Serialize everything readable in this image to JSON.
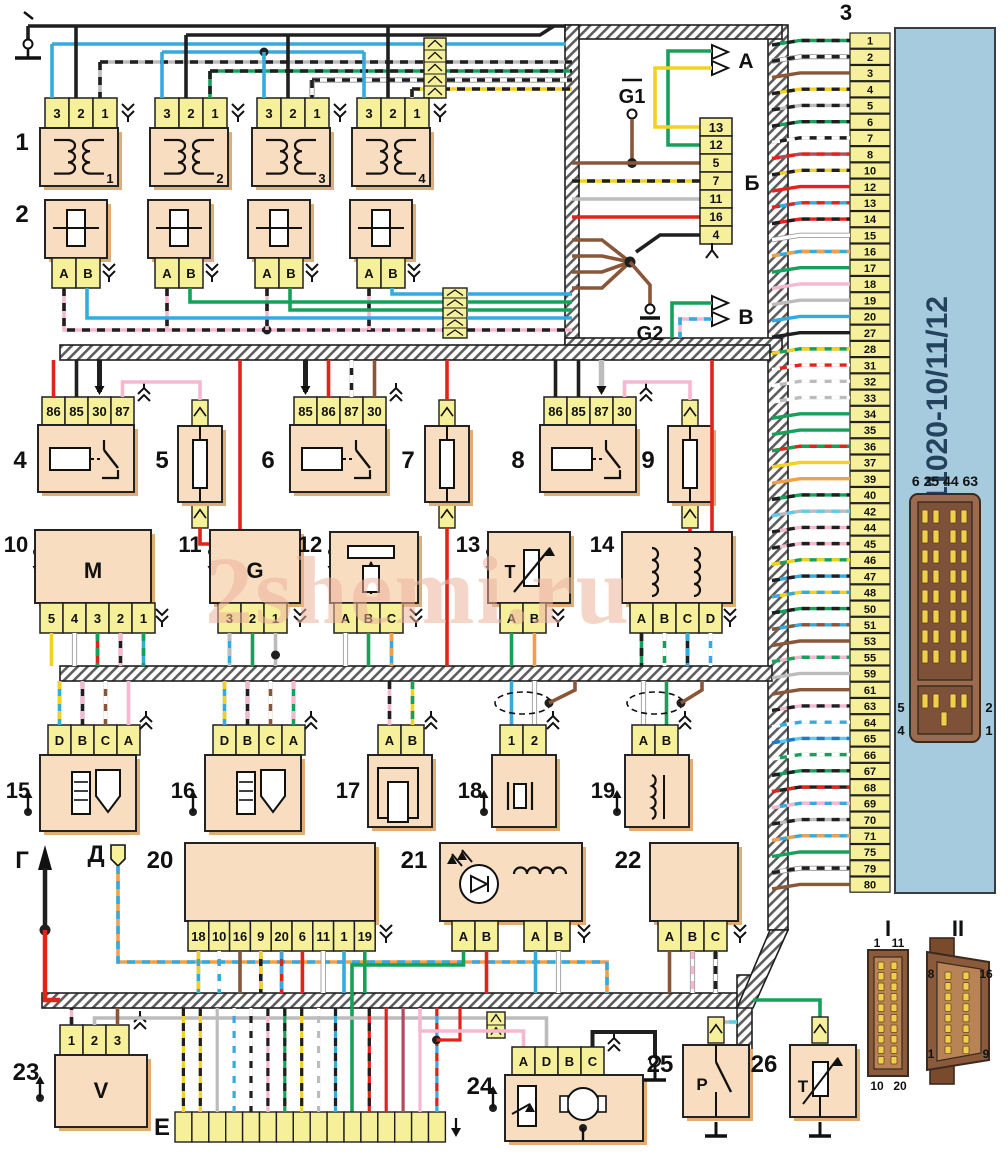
{
  "watermark": "2shemi.ru",
  "ecu": {
    "callout": "3",
    "title": "21124-1411020-10/11/12",
    "aux_connector_label": "6 25 44 63",
    "aux_side_labels": {
      "top_left": "5",
      "bottom_left": "4",
      "top_right": "2",
      "bottom_right": "1"
    },
    "pins": [
      {
        "n": "1",
        "wire": "green-black"
      },
      {
        "n": "2",
        "wire": "white-black"
      },
      {
        "n": "3",
        "wire": "brown"
      },
      {
        "n": "4",
        "wire": "yellow-black"
      },
      {
        "n": "5",
        "wire": "gray-black"
      },
      {
        "n": "6",
        "wire": "green-black"
      },
      {
        "n": "7",
        "wire": "black-white"
      },
      {
        "n": "8",
        "wire": "crimson-red"
      },
      {
        "n": "10",
        "wire": "yellow-black"
      },
      {
        "n": "12",
        "wire": "red"
      },
      {
        "n": "13",
        "wire": "blue-red"
      },
      {
        "n": "14",
        "wire": "red-black"
      },
      {
        "n": "15",
        "wire": "white"
      },
      {
        "n": "16",
        "wire": "blue-orange"
      },
      {
        "n": "17",
        "wire": "green"
      },
      {
        "n": "18",
        "wire": "pink"
      },
      {
        "n": "19",
        "wire": "gray"
      },
      {
        "n": "20",
        "wire": "blue"
      },
      {
        "n": "27",
        "wire": "black"
      },
      {
        "n": "28",
        "wire": "green-yellow"
      },
      {
        "n": "31",
        "wire": "red-white"
      },
      {
        "n": "32",
        "wire": "gray-white"
      },
      {
        "n": "33",
        "wire": "gray-white"
      },
      {
        "n": "34",
        "wire": "green"
      },
      {
        "n": "35",
        "wire": "green"
      },
      {
        "n": "36",
        "wire": "red-green"
      },
      {
        "n": "37",
        "wire": "yellow"
      },
      {
        "n": "39",
        "wire": "orange"
      },
      {
        "n": "40",
        "wire": "green-black"
      },
      {
        "n": "42",
        "wire": "gray-blue"
      },
      {
        "n": "44",
        "wire": "pink-black"
      },
      {
        "n": "45",
        "wire": "pink-black"
      },
      {
        "n": "46",
        "wire": "green-yellow"
      },
      {
        "n": "47",
        "wire": "blue-black"
      },
      {
        "n": "48",
        "wire": "yellow-blue"
      },
      {
        "n": "50",
        "wire": "green-black"
      },
      {
        "n": "51",
        "wire": "blue-brown"
      },
      {
        "n": "53",
        "wire": "brown"
      },
      {
        "n": "55",
        "wire": "pink-green"
      },
      {
        "n": "59",
        "wire": "gray"
      },
      {
        "n": "61",
        "wire": "brown"
      },
      {
        "n": "63",
        "wire": "pink-black"
      },
      {
        "n": "64",
        "wire": "blue-white"
      },
      {
        "n": "65",
        "wire": "cyan-blue"
      },
      {
        "n": "66",
        "wire": "green-white"
      },
      {
        "n": "67",
        "wire": "green-black"
      },
      {
        "n": "68",
        "wire": "black-red"
      },
      {
        "n": "69",
        "wire": "blue-pink"
      },
      {
        "n": "70",
        "wire": "gray-black"
      },
      {
        "n": "71",
        "wire": "blue-orange"
      },
      {
        "n": "75",
        "wire": "green"
      },
      {
        "n": "79",
        "wire": "white-black"
      },
      {
        "n": "80",
        "wire": "brown"
      }
    ]
  },
  "wire_colors": {
    "black": [
      "#1f1f1f",
      null
    ],
    "white": [
      "#ffffff",
      null
    ],
    "gray": [
      "#bcbcbc",
      null
    ],
    "brown": [
      "#8a5638",
      null
    ],
    "red": [
      "#e2231a",
      null
    ],
    "crimson": [
      "#b04a5e",
      null
    ],
    "orange": [
      "#f0a04a",
      null
    ],
    "yellow": [
      "#f2d21f",
      null
    ],
    "green": [
      "#17a05a",
      null
    ],
    "blue": [
      "#35aadf",
      null
    ],
    "pink": [
      "#f5b8d0",
      null
    ],
    "green-black": [
      "#17a05a",
      "#1f1f1f"
    ],
    "white-black": [
      "#ffffff",
      "#1f1f1f"
    ],
    "yellow-black": [
      "#f2d21f",
      "#1f1f1f"
    ],
    "gray-black": [
      "#bcbcbc",
      "#1f1f1f"
    ],
    "black-white": [
      "#1f1f1f",
      "#ffffff"
    ],
    "crimson-red": [
      "#b04a5e",
      "#e2231a"
    ],
    "blue-red": [
      "#35aadf",
      "#e2231a"
    ],
    "red-black": [
      "#e2231a",
      "#1f1f1f"
    ],
    "blue-orange": [
      "#35aadf",
      "#f0a04a"
    ],
    "green-yellow": [
      "#17a05a",
      "#f2d21f"
    ],
    "red-white": [
      "#e2231a",
      "#ffffff"
    ],
    "gray-white": [
      "#bcbcbc",
      "#ffffff"
    ],
    "red-green": [
      "#e2231a",
      "#17a05a"
    ],
    "gray-blue": [
      "#bcbcbc",
      "#5ecbee"
    ],
    "pink-black": [
      "#f5b8d0",
      "#1f1f1f"
    ],
    "blue-black": [
      "#35aadf",
      "#1f1f1f"
    ],
    "yellow-blue": [
      "#f2d21f",
      "#35aadf"
    ],
    "blue-brown": [
      "#35aadf",
      "#8a5638"
    ],
    "pink-green": [
      "#f5b8d0",
      "#17a05a"
    ],
    "blue-white": [
      "#35aadf",
      "#ffffff"
    ],
    "cyan-blue": [
      "#5ecbee",
      "#1f78c8"
    ],
    "green-white": [
      "#17a05a",
      "#ffffff"
    ],
    "black-red": [
      "#1f1f1f",
      "#e2231a"
    ],
    "blue-pink": [
      "#35aadf",
      "#f5b8d0"
    ],
    "pink-blue": [
      "#f5b8d0",
      "#35aadf"
    ],
    "gray-cyan": [
      "#bcbcbc",
      "#5ecbee"
    ],
    "black-pink": [
      "#1f1f1f",
      "#f5b8d0"
    ],
    "black-yellow": [
      "#1f1f1f",
      "#f2d21f"
    ],
    "red-blue": [
      "#e2231a",
      "#35aadf"
    ],
    "blue-yellow": [
      "#35aadf",
      "#f2d21f"
    ],
    "blue-gray": [
      "#35aadf",
      "#bcbcbc"
    ],
    "green-pink": [
      "#17a05a",
      "#f5b8d0"
    ],
    "white-pink": [
      "#ffffff",
      "#f5b8d0"
    ],
    "brown-white": [
      "#8a5638",
      "#ffffff"
    ],
    "yellow-green": [
      "#f2d21f",
      "#17a05a"
    ],
    "black-blue": [
      "#1f1f1f",
      "#35aadf"
    ],
    "blue-green": [
      "#35aadf",
      "#17a05a"
    ],
    "orange-blue": [
      "#f0a04a",
      "#35aadf"
    ]
  },
  "shield_box": {
    "out_a": "А",
    "out_b": "В",
    "strip_label": "Б",
    "g1": "G1",
    "g2": "G2",
    "strip_pins": [
      "13",
      "12",
      "5",
      "7",
      "11",
      "16",
      "4"
    ]
  },
  "ignition_coils": {
    "callout": "1",
    "pin_labels": [
      "3",
      "2",
      "1"
    ],
    "units": [
      "1",
      "2",
      "3",
      "4"
    ]
  },
  "injectors": {
    "callout": "2",
    "pin_labels": [
      "A",
      "B"
    ]
  },
  "relays": [
    {
      "callout": "4",
      "pins": [
        "86",
        "85",
        "30",
        "87"
      ]
    },
    {
      "callout": "6",
      "pins": [
        "85",
        "86",
        "87",
        "30"
      ]
    },
    {
      "callout": "8",
      "pins": [
        "86",
        "85",
        "87",
        "30"
      ]
    }
  ],
  "fuses": [
    {
      "callout": "5"
    },
    {
      "callout": "7"
    },
    {
      "callout": "9"
    }
  ],
  "sensors": [
    {
      "callout": "10",
      "mark": "M",
      "pins": [
        "5",
        "4",
        "3",
        "2",
        "1"
      ],
      "wires": [
        "yellow",
        "white",
        "red-green",
        "black-pink",
        "blue-green"
      ]
    },
    {
      "callout": "11",
      "mark": "G",
      "pins": [
        "3",
        "2",
        "1"
      ],
      "wires": [
        "blue-gray",
        "green",
        "gray"
      ]
    },
    {
      "callout": "12",
      "mark": "",
      "pins": [
        "A",
        "B",
        "C"
      ],
      "wires": [
        "white",
        "green",
        "blue-orange"
      ]
    },
    {
      "callout": "13",
      "mark": "T",
      "pins": [
        "A",
        "B"
      ],
      "wires": [
        "green",
        "orange"
      ]
    },
    {
      "callout": "14",
      "mark": "",
      "pins": [
        "A",
        "B",
        "C",
        "D"
      ],
      "wires": [
        "green-black",
        "green-white",
        "black-blue",
        "blue-white"
      ]
    }
  ],
  "sensors2": [
    {
      "callout": "15",
      "pins": [
        "D",
        "B",
        "C",
        "A"
      ],
      "wires": [
        "blue-yellow",
        "black-pink",
        "brown-white",
        "pink"
      ]
    },
    {
      "callout": "16",
      "pins": [
        "D",
        "B",
        "C",
        "A"
      ],
      "wires": [
        "blue-yellow",
        "black-pink",
        "brown-white",
        "green-pink"
      ]
    },
    {
      "callout": "17",
      "pins": [
        "A",
        "B"
      ],
      "wires": [
        "pink-black",
        "yellow-green"
      ]
    },
    {
      "callout": "18",
      "pins": [
        "1",
        "2"
      ],
      "wires": [
        "blue",
        "white"
      ]
    },
    {
      "callout": "19",
      "pins": [
        "A",
        "B"
      ],
      "wires": [
        "white",
        "green"
      ]
    }
  ],
  "blocks": {
    "b20": {
      "callout": "20",
      "pins": [
        "18",
        "10",
        "16",
        "9",
        "20",
        "6",
        "11",
        "1",
        "19"
      ],
      "wires": [
        "blue-yellow",
        "blue-white",
        "brown",
        "black-yellow",
        "red-blue",
        "red",
        "white",
        "blue",
        "green"
      ]
    },
    "b21": {
      "callout": "21",
      "pins_left": [
        "A",
        "B"
      ],
      "pins_right": [
        "A",
        "B"
      ],
      "wires_left": [
        "green",
        "red"
      ],
      "wires_right": [
        "blue",
        "white"
      ]
    },
    "b22": {
      "callout": "22",
      "pins": [
        "A",
        "B",
        "C"
      ],
      "wires": [
        "brown",
        "white-pink",
        "white-black"
      ]
    },
    "b23": {
      "callout": "23",
      "mark": "V",
      "pins": [
        "1",
        "2",
        "3"
      ],
      "wires": [
        "pink-black",
        "gray",
        "brown"
      ]
    },
    "b24": {
      "callout": "24",
      "pins": [
        "A",
        "D",
        "B",
        "C"
      ]
    },
    "b25": {
      "callout": "25",
      "mark": "P"
    },
    "b26": {
      "callout": "26",
      "mark": "T"
    }
  },
  "grounds": {
    "g": "Г",
    "d": "Д",
    "e": "Е"
  },
  "e_strip": {
    "cells": 16,
    "wires": [
      "yellow-black",
      "yellow-black",
      "gray",
      "blue-white",
      "black-white",
      "pink-black",
      "green-black",
      "yellow-black",
      "gray-white",
      "blue-black",
      "",
      "red-black",
      "red",
      "crimson",
      "pink",
      "blue-red"
    ]
  },
  "connector_I": {
    "label": "I",
    "top_left": "1",
    "top_right": "11",
    "bottom_left": "10",
    "bottom_right": "20"
  },
  "connector_II": {
    "label": "II",
    "top_left": "8",
    "top_right": "16",
    "bottom_left": "1",
    "bottom_right": "9"
  }
}
